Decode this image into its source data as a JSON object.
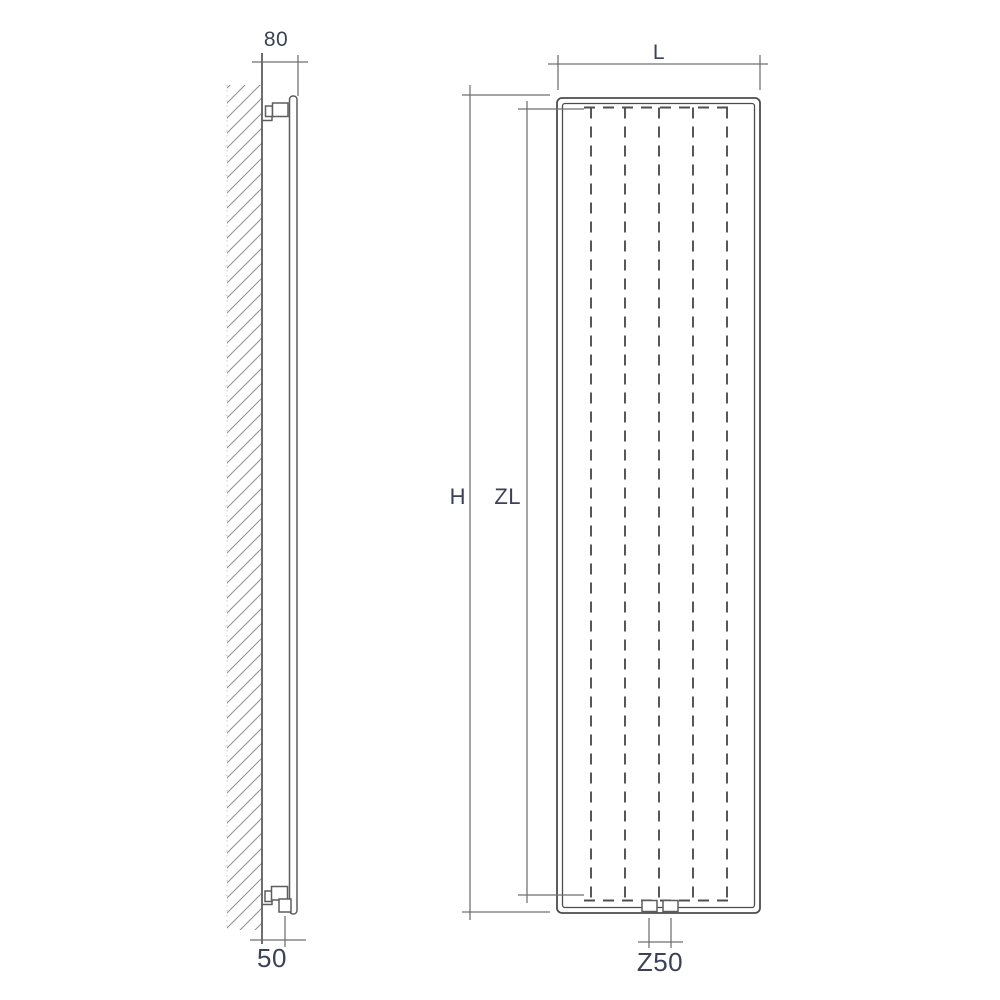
{
  "diagram": {
    "type": "radiator-technical-drawing",
    "side_view": {
      "depth_label": "80",
      "bottom_connection_label": "50"
    },
    "front_view": {
      "width_label": "L",
      "height_label": "H",
      "element_height_label": "ZL",
      "connection_spacing_label": "Z50"
    }
  },
  "colors": {
    "background": "#ffffff",
    "drawing_line": "#5d5d5d",
    "radiator_outline": "#4c4c4c",
    "dimension_line": "#6f6f6f",
    "hidden_dash_line": "#4f4f4f",
    "wall_hatch": "#949494",
    "label_text": "#3b4156"
  }
}
